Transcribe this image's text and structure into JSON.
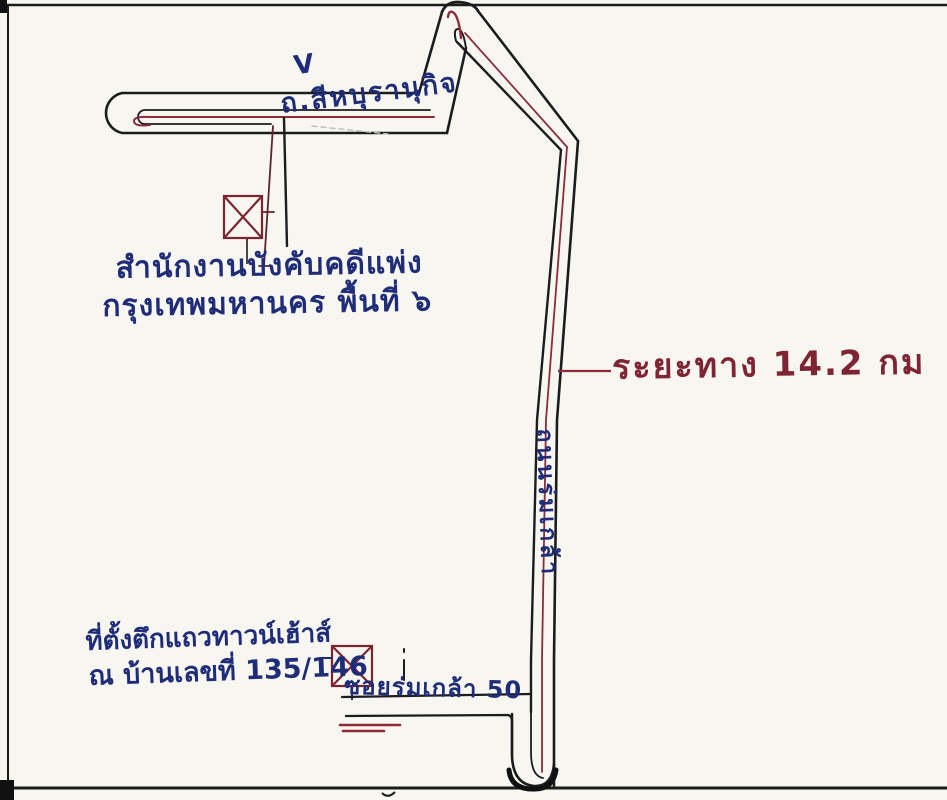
{
  "map": {
    "office": {
      "line1": "สำนักงานบังคับคดีแพ่ง",
      "line2": "กรุงเทพมหานคร พื้นที่ ๖"
    },
    "roads": {
      "top_road_label": "ถ.สีหบุรานุกิจ",
      "vertical_road_label": "ถนนร่มเกล้า",
      "soi_label": "ซอยร่มเกล้า 50"
    },
    "distance_label": "ระยะทาง 14.2 กม",
    "destination": {
      "line1": "ที่ตั้งตึกแถวทาวน์เฮ้าส์",
      "line2": "ณ บ้านเลขที่ 135/146"
    },
    "caret_mark": "V",
    "colors": {
      "ink_black": "#1c1c1c",
      "ink_red": "#8d2b3b",
      "ink_blue": "#1f2d78",
      "paper": "#f7f6f1"
    }
  }
}
